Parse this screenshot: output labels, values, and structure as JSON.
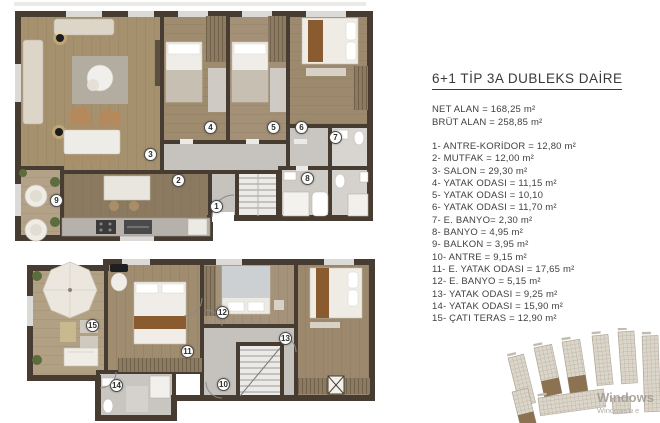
{
  "info_panel": {
    "title": "6+1 TİP 3A DUBLEKS DAİRE",
    "net_alan": "NET ALAN = 168,25 m²",
    "brut_alan": "BRÜT ALAN = 258,85 m²",
    "rooms": [
      "1- ANTRE-KORİDOR = 12,80 m²",
      "2- MUTFAK = 12,00 m²",
      "3- SALON = 29,30 m²",
      "4- YATAK ODASI = 11,15 m²",
      "5- YATAK ODASI = 10,10",
      "6- YATAK ODASI = 11,70 m²",
      "7- E. BANYO= 2,30 m²",
      "8- BANYO = 4,95 m²",
      "9- BALKON = 3,95 m²",
      "10- ANTRE = 9,15 m²",
      "11- E. YATAK ODASI = 17,65 m²",
      "12- E. BANYO = 5,15 m²",
      "13- YATAK ODASI = 9,25 m²",
      "14- YATAK ODASI = 15,90 m²",
      "15- ÇATI TERAS = 12,90 m²"
    ]
  },
  "plan_labels": [
    {
      "n": "1",
      "x": 217,
      "y": 207
    },
    {
      "n": "2",
      "x": 179,
      "y": 181
    },
    {
      "n": "3",
      "x": 151,
      "y": 155
    },
    {
      "n": "4",
      "x": 211,
      "y": 128
    },
    {
      "n": "5",
      "x": 274,
      "y": 128
    },
    {
      "n": "6",
      "x": 302,
      "y": 128
    },
    {
      "n": "7",
      "x": 336,
      "y": 138
    },
    {
      "n": "8",
      "x": 308,
      "y": 179
    },
    {
      "n": "9",
      "x": 57,
      "y": 201
    },
    {
      "n": "10",
      "x": 224,
      "y": 385
    },
    {
      "n": "11",
      "x": 188,
      "y": 352
    },
    {
      "n": "12",
      "x": 223,
      "y": 313
    },
    {
      "n": "13",
      "x": 286,
      "y": 339
    },
    {
      "n": "14",
      "x": 117,
      "y": 386
    },
    {
      "n": "15",
      "x": 93,
      "y": 326
    }
  ],
  "watermark": {
    "line1": "Windows",
    "line2": "Windows'u e"
  },
  "colors": {
    "wall": "#473c31",
    "wood_floor": "#a28c6e",
    "kitchen_floor": "#8c7a60",
    "marble_floor": "#c6c3bf",
    "terrace_floor": "#b1a083",
    "accent_brown": "#8a5b2f",
    "furniture_white": "#f0ede8",
    "plant_green": "#5c6c3c",
    "text": "#3c3c3c",
    "watermark_gray": "#9d9993"
  }
}
